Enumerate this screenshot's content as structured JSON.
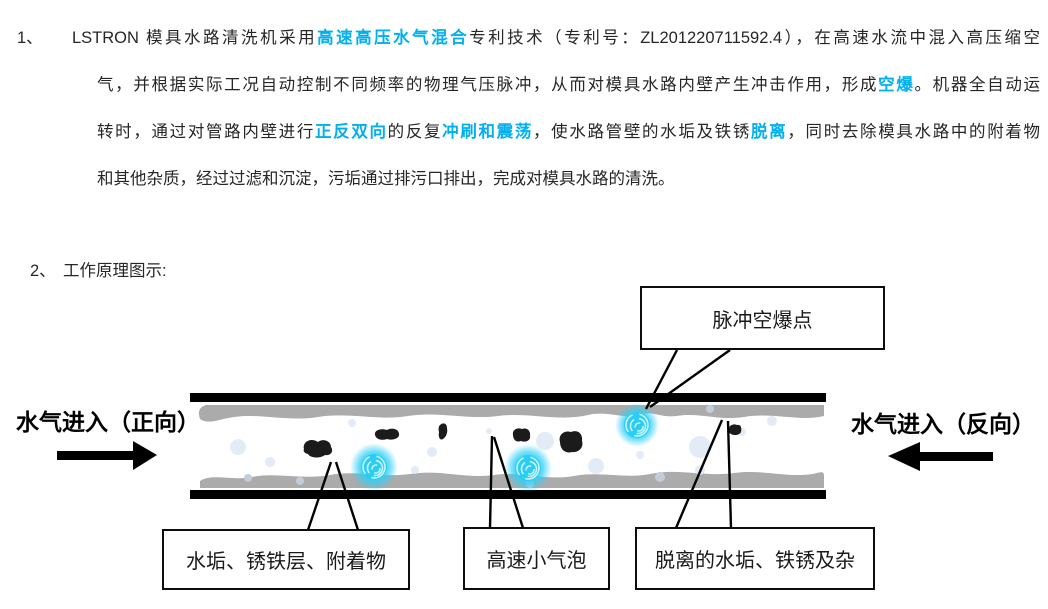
{
  "colors": {
    "accent": "#00b0f0",
    "pipe_wall": "#000000",
    "scale_layer": "#ababab",
    "debris": "#1b1b1b",
    "bubble": "#2bcdf4"
  },
  "paragraph": {
    "number": "1、",
    "lines": [
      [
        {
          "t": "LSTRON 模具水路清洗机采用"
        },
        {
          "t": "高速高压水气混合",
          "h": true
        },
        {
          "t": "专利技术（专利号：ZL201220711592.4），在高速水流中混入高压缩空"
        }
      ],
      [
        {
          "t": "气，并根据实际工况自动控制不同频率的物理气压脉冲，从而对模具水路内壁产生冲击作用，形成"
        },
        {
          "t": "空爆",
          "h": true
        },
        {
          "t": "。机器全自动运"
        }
      ],
      [
        {
          "t": "转时，通过对管路内壁进行"
        },
        {
          "t": "正反双向",
          "h": true
        },
        {
          "t": "的反复"
        },
        {
          "t": "冲刷和震荡",
          "h": true
        },
        {
          "t": "，使水路管壁的水垢及铁锈"
        },
        {
          "t": "脱离",
          "h": true
        },
        {
          "t": "，同时去除模具水路中的附着物"
        }
      ],
      [
        {
          "t": "和其他杂质，经过过滤和沉淀，污垢通过排污口排出，完成对模具水路的清洗。"
        }
      ]
    ]
  },
  "section2": {
    "number": "2、",
    "label": "工作原理图示:"
  },
  "diagram": {
    "flow_in_forward": "水气进入（正向）",
    "flow_in_reverse": "水气进入（反向）",
    "callout_top": "脉冲空爆点",
    "callout_deposit": "水垢、锈铁层、附着物",
    "callout_bubble": "高速小气泡",
    "callout_detached": "脱离的水垢、铁锈及杂"
  }
}
